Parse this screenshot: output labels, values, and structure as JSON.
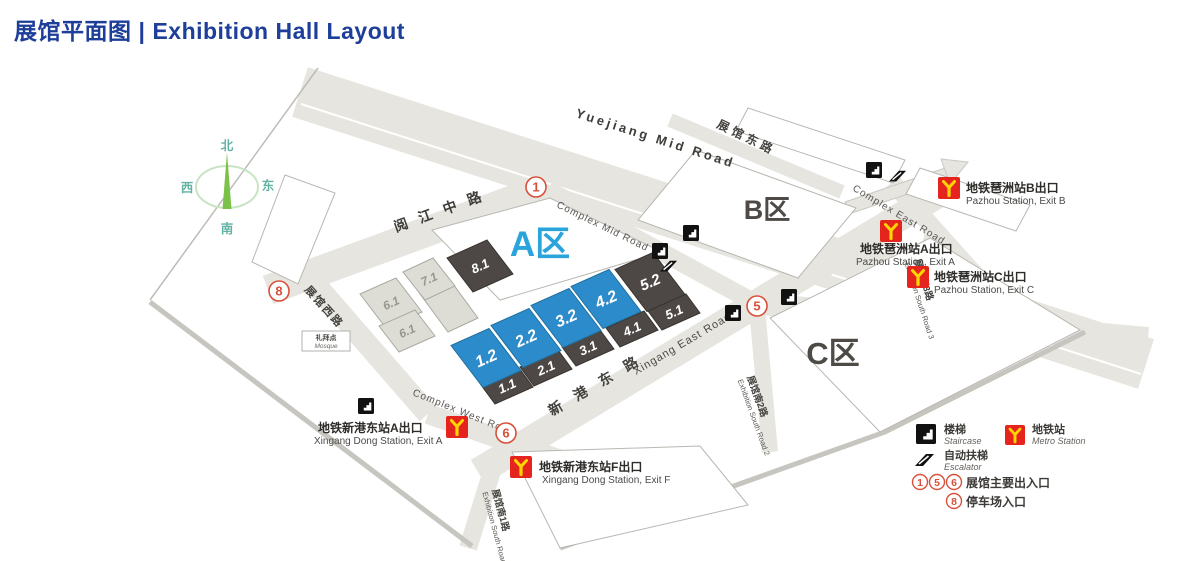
{
  "title": {
    "zh": "展馆平面图",
    "divider": "|",
    "en": "Exhibition Hall Layout"
  },
  "compass": {
    "north": "北",
    "south": "南",
    "east": "东",
    "west": "西"
  },
  "areas": [
    {
      "label": "A区",
      "color": "#2ba4dc"
    },
    {
      "label": "B区",
      "color": "#4e4a46"
    },
    {
      "label": "C区",
      "color": "#4e4a46"
    }
  ],
  "halls": [
    {
      "label": "1.2",
      "type": "blue"
    },
    {
      "label": "2.2",
      "type": "blue"
    },
    {
      "label": "3.2",
      "type": "blue"
    },
    {
      "label": "4.2",
      "type": "blue"
    },
    {
      "label": "5.2",
      "type": "dark"
    },
    {
      "label": "1.1",
      "type": "dark"
    },
    {
      "label": "2.1",
      "type": "dark"
    },
    {
      "label": "3.1",
      "type": "dark"
    },
    {
      "label": "4.1",
      "type": "dark"
    },
    {
      "label": "5.1",
      "type": "dark"
    },
    {
      "label": "8.1",
      "type": "dark"
    },
    {
      "label": "7.1",
      "type": "light"
    },
    {
      "label": "6.1",
      "type": "light"
    },
    {
      "label": "6.1",
      "type": "light"
    }
  ],
  "roads": [
    {
      "en": "Yuejiang Mid Road"
    },
    {
      "zh": "阅江中路"
    },
    {
      "en": "Complex Mid Road"
    },
    {
      "zh": "展馆东路"
    },
    {
      "en": "Complex East Road"
    },
    {
      "en": "Complex West Road"
    },
    {
      "zh": "展馆西路"
    },
    {
      "en": "Xingang East Road"
    },
    {
      "zh": "新港东路"
    },
    {
      "zh": "展馆南1路",
      "en": "Exhibition South Road 1"
    },
    {
      "zh": "展馆南2路",
      "en": "Exhibition South Road 2"
    },
    {
      "zh": "展馆南3路",
      "en": "Exhibition South Road 3"
    }
  ],
  "stations": [
    {
      "zh": "地铁琶洲站B出口",
      "en": "Pazhou Station, Exit B"
    },
    {
      "zh": "地铁琶洲站A出口",
      "en": "Pazhou Station, Exit A"
    },
    {
      "zh": "地铁琶洲站C出口",
      "en": "Pazhou Station, Exit C"
    },
    {
      "zh": "地铁新港东站A出口",
      "en": "Xingang Dong Station, Exit A"
    },
    {
      "zh": "地铁新港东站F出口",
      "en": "Xingang Dong Station, Exit F"
    }
  ],
  "entrances": [
    {
      "num": "1"
    },
    {
      "num": "5"
    },
    {
      "num": "6"
    },
    {
      "num": "8"
    }
  ],
  "poi": {
    "mosque_zh": "礼拜点",
    "mosque_en": "Mosque"
  },
  "legend": {
    "staircase_zh": "楼梯",
    "staircase_en": "Staircase",
    "metro_zh": "地铁站",
    "metro_en": "Metro Station",
    "escalator_zh": "自动扶梯",
    "escalator_en": "Escalator",
    "main_entrance_nums": [
      "1",
      "5",
      "6"
    ],
    "main_entrance_label": "展馆主要出入口",
    "parking_num": "8",
    "parking_label": "停车场入口"
  },
  "colors": {
    "title_blue": "#1d3e99",
    "area_a_blue": "#2ba4dc",
    "hall_blue": "#2c8bca",
    "hall_dark": "#4d4845",
    "hall_light": "#dddcd5",
    "road_gray": "#e6e5df",
    "entrance_red": "#d9503a",
    "metro_red": "#e5251d",
    "metro_yellow": "#ffd503",
    "compass_green": "#7cc24a",
    "compass_teal": "#63b3a5"
  }
}
